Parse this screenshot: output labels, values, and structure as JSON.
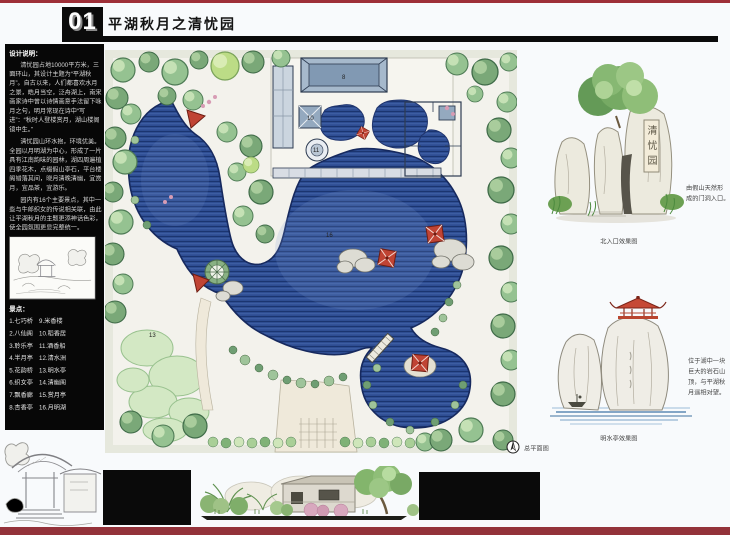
{
  "header": {
    "number": "01",
    "title": "平湖秋月之清忧园"
  },
  "sidebar": {
    "notes_title": "设计说明：",
    "paragraphs": [
      "清忧园占地10000平方米，三面环山，其设计主题为“平湖秋月”。自古以来，人们都喜欢水月之景，皓月当空，泛舟湖上，南宋画家诗中曾以诗情画意手法留下咏月之句，明月常现在诗中“写进”：“秋时人登楼赏月，湖山楼阁镜中生。”",
      "清忧园山环水抱，环境优美。全园以月明湖为中心，形成了一片具有江南韵味的园林，湖四周遍植四季花木，点缀假山亭石，平台楼阁错落其间，晓月清晚清幽，宜赏月，宜品茶，宜游乐。",
      "园内有16个主要景点，其中一些与牛郎织女的传说相关联，由此让平湖秋月的主题更添神话色彩，使全园氛围更显完整统一。"
    ],
    "legend_title": "景点：",
    "legend_left": [
      "1.七巧桥",
      "2.八仙阁",
      "3.聆乐亭",
      "4.半月亭",
      "5.花韵桥",
      "6.织女亭",
      "7.飘香廊",
      "8.杏香亭"
    ],
    "legend_right": [
      "9.米香楼",
      "10.稻香居",
      "11.酒香船",
      "12.清水洲",
      "13.明水亭",
      "14.清幽阁",
      "15.赏月亭",
      "16.月明湖"
    ]
  },
  "plan": {
    "caption": "总平面图",
    "labels": [
      {
        "text": "8"
      },
      {
        "text": "10"
      },
      {
        "text": "11"
      },
      {
        "text": "16"
      },
      {
        "text": "13"
      }
    ]
  },
  "right_panel": {
    "sketch1_caption": "北入口效果图",
    "note1_lines": [
      "由假山天然形",
      "成的门洞入口。"
    ],
    "plaque_chars": [
      "清",
      "忧",
      "园"
    ],
    "sketch2_caption": "明水亭效果图",
    "note2_lines": [
      "位于湖中一块",
      "巨大的岩石山",
      "顶，与平湖秋",
      "月遥相对望。"
    ]
  },
  "colors": {
    "accent_red": "#9e2f38",
    "lake_blue": "#2e4d92",
    "panel_black": "#0a0a0a"
  }
}
